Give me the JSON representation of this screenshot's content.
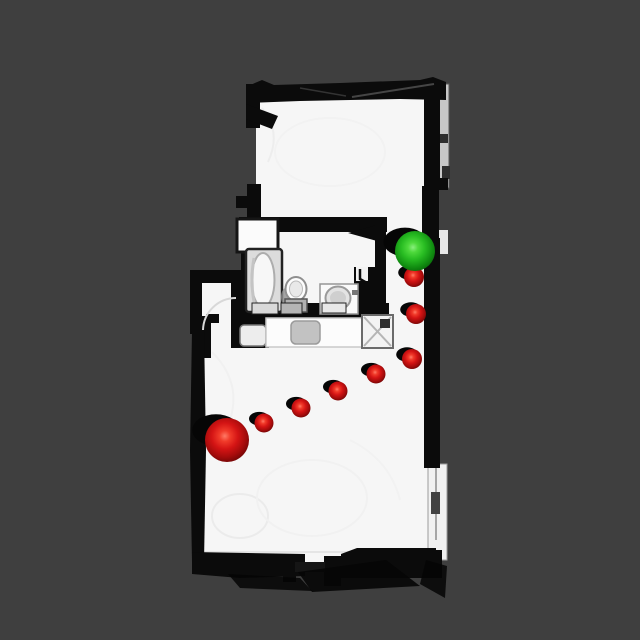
{
  "scene": {
    "kind": "topdown-3d-scan-floorplan-with-trajectory",
    "background_color": "#3f3f3f",
    "floor_color": "#f6f6f6",
    "wall_color": "#0b0b0b",
    "outer_ledge_color": "#c7c7c7"
  },
  "palette": {
    "red_sphere_stops": [
      "#ff7a66",
      "#f13b2a",
      "#d41414",
      "#a30b0b",
      "#700606"
    ],
    "green_sphere_stops": [
      "#8aef7e",
      "#4ed93c",
      "#28bc22",
      "#129112",
      "#0a6e0a"
    ],
    "sphere_shadow": "#060606"
  },
  "trajectory": {
    "start": {
      "x": 227,
      "y": 440,
      "r": 22,
      "color": "red"
    },
    "waypoints": [
      {
        "x": 264,
        "y": 423,
        "r": 9.5,
        "color": "red"
      },
      {
        "x": 301,
        "y": 408,
        "r": 9.5,
        "color": "red"
      },
      {
        "x": 338,
        "y": 391,
        "r": 9.5,
        "color": "red"
      },
      {
        "x": 376,
        "y": 374,
        "r": 9.5,
        "color": "red"
      },
      {
        "x": 412,
        "y": 359,
        "r": 10,
        "color": "red"
      },
      {
        "x": 416,
        "y": 314,
        "r": 10,
        "color": "red"
      },
      {
        "x": 414,
        "y": 277,
        "r": 10,
        "color": "red"
      }
    ],
    "goal": {
      "x": 415,
      "y": 251,
      "r": 20,
      "color": "green"
    }
  },
  "rooms": [
    "upper-room",
    "bathroom",
    "hallway",
    "main-room",
    "entry-alcove"
  ],
  "fixtures": [
    "closet",
    "bathtub",
    "toilet",
    "sink",
    "kitchen-counter",
    "counter-item",
    "side-table",
    "washing-machine"
  ]
}
